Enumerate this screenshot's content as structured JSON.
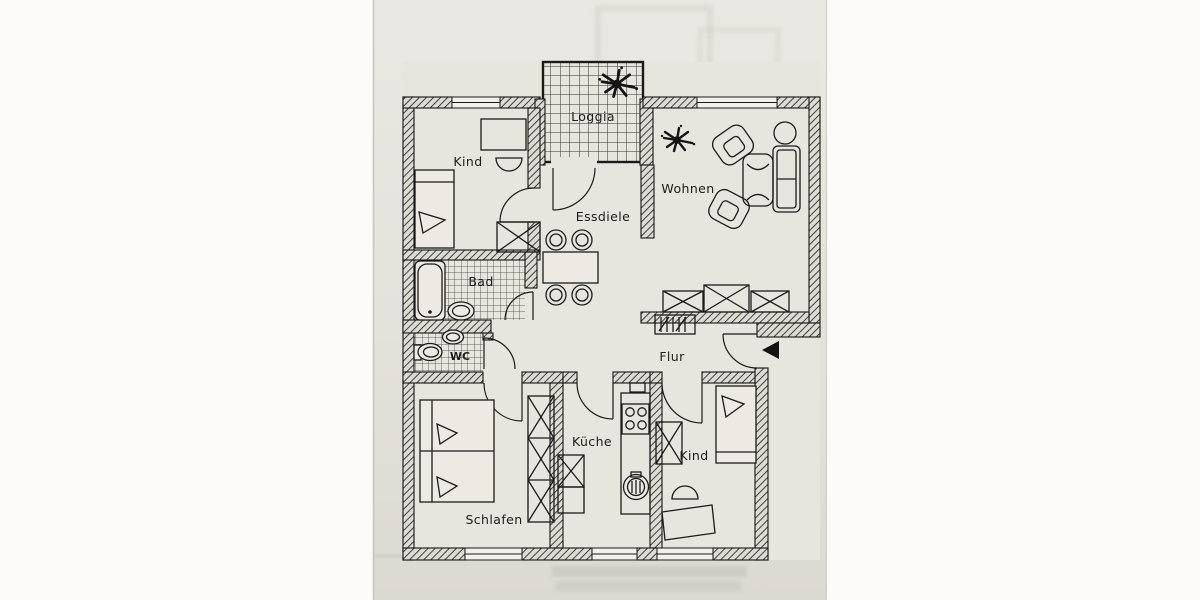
{
  "document": {
    "kind": "scanned-floor-plan-photo",
    "language": "de"
  },
  "rooms": {
    "kind_top": "Kind",
    "loggia": "Loggia",
    "wohnen": "Wohnen",
    "essdiele": "Essdiele",
    "bad": "Bad",
    "wc": "WC",
    "flur": "Flur",
    "kueche": "Küche",
    "kind_bottom": "Kind",
    "schlafen": "Schlafen"
  },
  "symbols": {
    "entrance_arrow": "arrow-left-entrance",
    "light_splat": "ceiling-light-symbol",
    "wardrobe_box": "crossed-cabinet-symbol"
  },
  "colors": {
    "paper": "#fcfbf9",
    "photo_top": "#e9e8e2",
    "photo_bottom": "#dbdad2",
    "ink": "#1b1b1b"
  }
}
